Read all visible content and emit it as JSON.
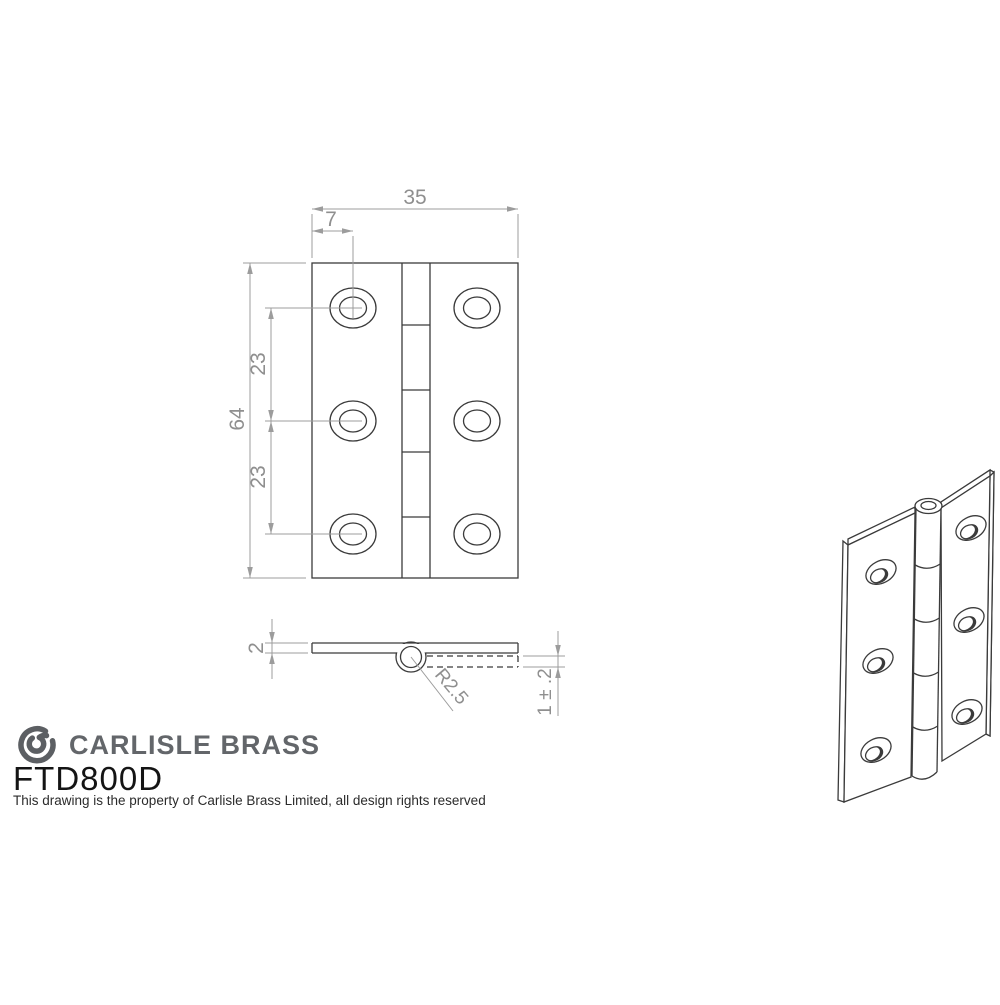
{
  "front_view": {
    "width": "35",
    "hole_offset": "7",
    "height": "64",
    "spacing_top": "23",
    "spacing_bottom": "23"
  },
  "side_view": {
    "thickness": "2",
    "knuckle_radius": "R2.5",
    "leaf_tolerance": "1 ± .2"
  },
  "brand": {
    "logo_icon": "carlisle-brass-logo",
    "name": "CARLISLE BRASS",
    "product_code": "FTD800D",
    "disclaimer": "This drawing is the property of Carlisle Brass Limited, all design rights reserved"
  },
  "colors": {
    "outline": "#3b3b3b",
    "dimension": "#9c9c9c",
    "brand_gray": "#63666a",
    "text": "#1a1a1a",
    "background": "#ffffff"
  }
}
